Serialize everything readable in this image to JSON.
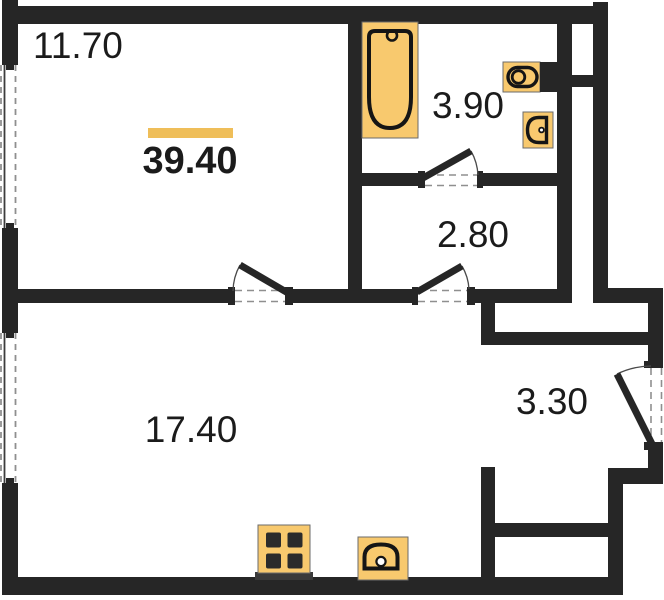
{
  "plan": {
    "type": "apartment-floor-plan",
    "total_area": "39.40",
    "rooms": [
      {
        "id": "room-top-left",
        "area": "11.70"
      },
      {
        "id": "bathroom",
        "area": "3.90"
      },
      {
        "id": "hall-corridor",
        "area": "2.80"
      },
      {
        "id": "living-kitchen",
        "area": "17.40"
      },
      {
        "id": "entry-hall",
        "area": "3.30"
      }
    ],
    "fixtures": [
      "bathtub",
      "toilet",
      "washbasin",
      "cooktop",
      "kitchen-sink"
    ],
    "doors": [
      "bathroom-door",
      "room-top-left-door",
      "corridor-door",
      "entry-door"
    ],
    "windows": [
      "window-left-upper",
      "window-left-lower"
    ]
  },
  "colors": {
    "wall": "#262626",
    "fixture_fill": "#F8C96E",
    "accent_bar": "#EFBE59",
    "dash": "#8f8f8f",
    "arc": "#4a4a4a",
    "window_line": "#3c3c3c",
    "text": "#1b1b1b",
    "burner": "#2b2b2b",
    "base_strip": "#3a3a3a",
    "background": "#ffffff"
  }
}
